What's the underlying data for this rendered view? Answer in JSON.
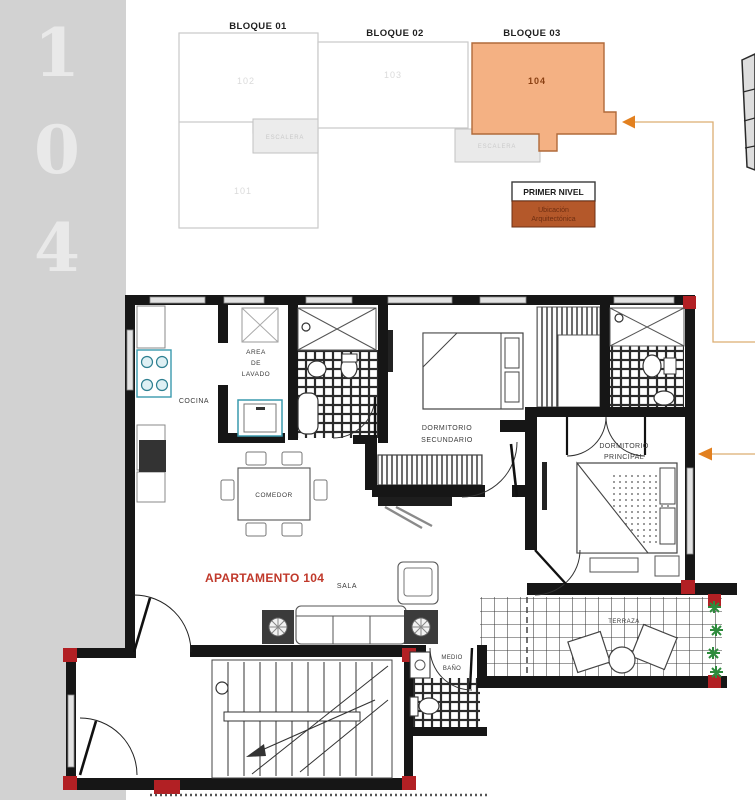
{
  "sidebar": {
    "digits": [
      "1",
      "0",
      "4"
    ]
  },
  "key_plan": {
    "block1_label": "BLOQUE 01",
    "block2_label": "BLOQUE 02",
    "block3_label": "BLOQUE 03",
    "unit_101": "101",
    "unit_102": "102",
    "unit_103": "103",
    "unit_104": "104",
    "stair1_label": "ESCALERA",
    "stair2_label": "ESCALERA",
    "legend_title": "PRIMER NIVEL",
    "legend_sub1": "Ubicación",
    "legend_sub2": "Arquitectónica"
  },
  "floor_plan": {
    "apartment_label": "APARTAMENTO 104",
    "cocina": "COCINA",
    "area_lavado": [
      "AREA",
      "DE",
      "LAVADO"
    ],
    "comedor": "COMEDOR",
    "sala": "SALA",
    "dormitorio_secundario": [
      "DORMITORIO",
      "SECUNDARIO"
    ],
    "dormitorio_principal": [
      "DORMITORIO",
      "PRINCIPAL"
    ],
    "medio_bano": [
      "MEDIO",
      "BAÑO"
    ],
    "terraza": "TERRAZA"
  },
  "colors": {
    "highlight_orange": "#f4b183",
    "legend_brown": "#b4582a",
    "apartment_red": "#c0392b",
    "column_red": "#b22024",
    "plant_green": "#2e8b3d",
    "sidebar_gray": "#d2d2d2"
  }
}
